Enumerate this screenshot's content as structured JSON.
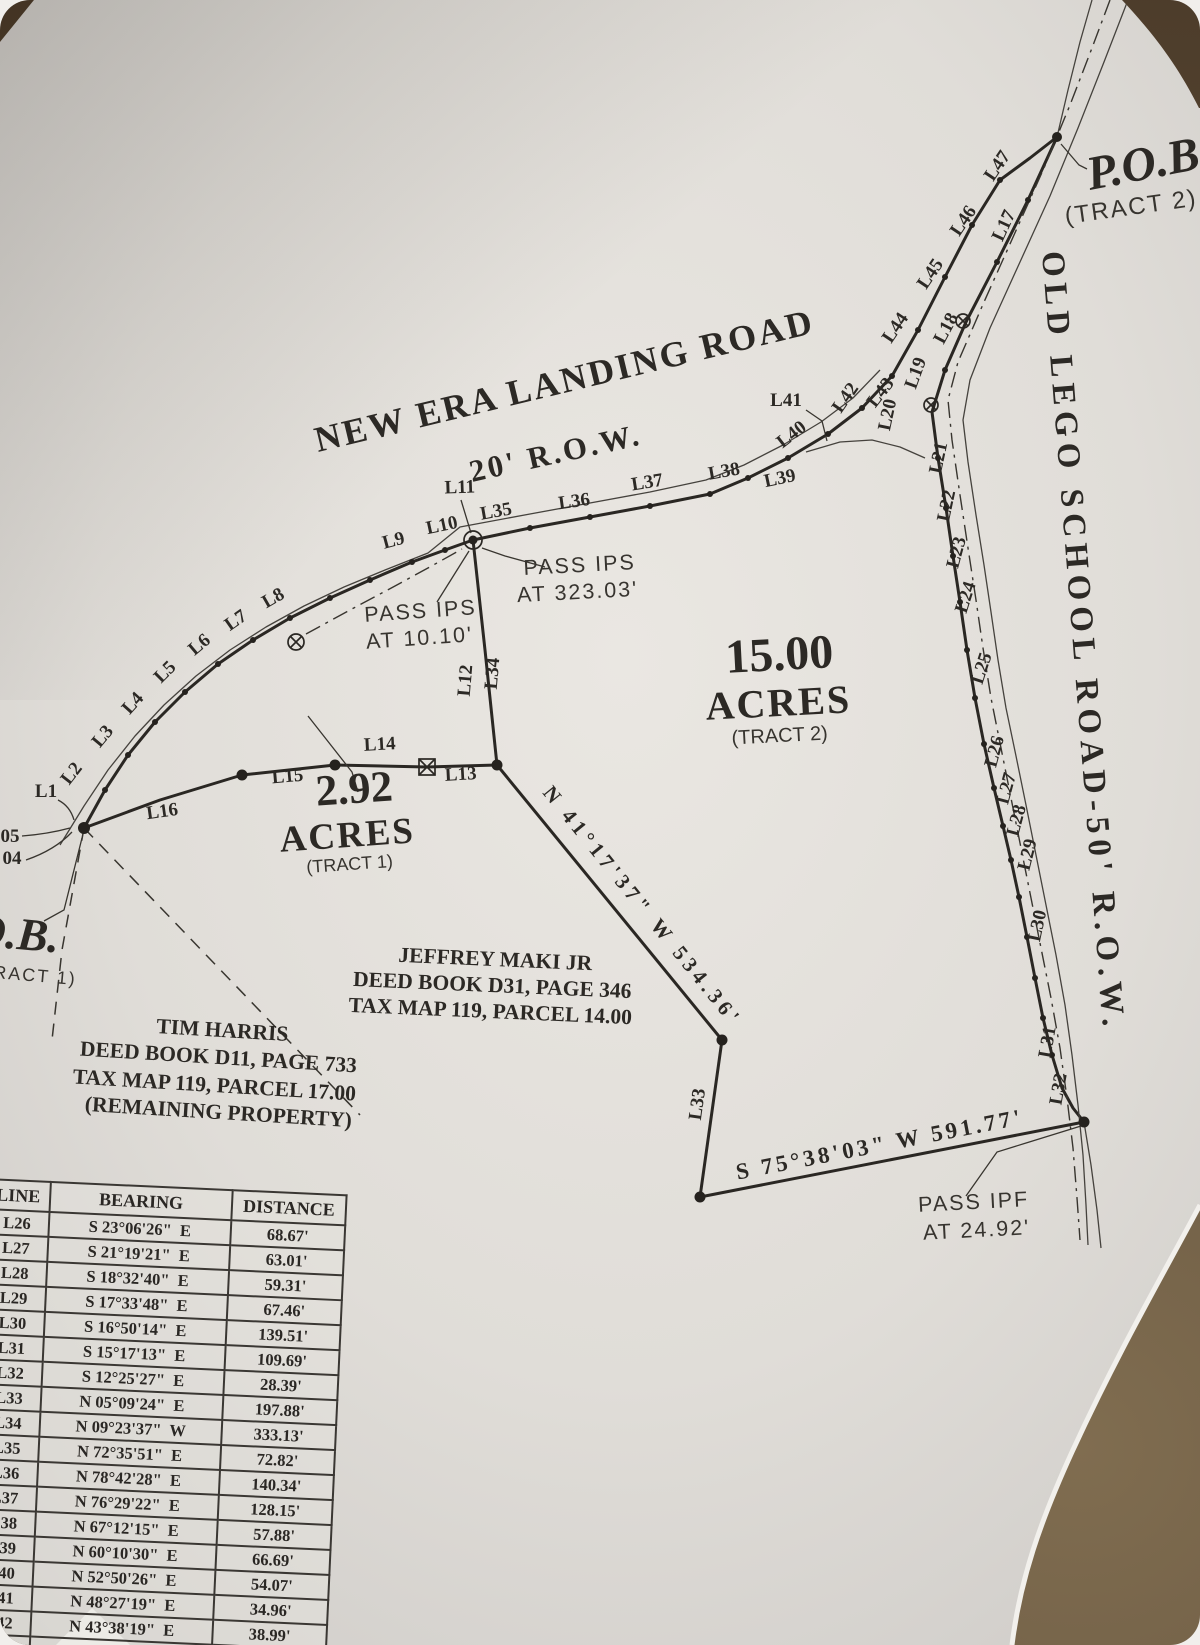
{
  "roads": {
    "new_era": {
      "name": "NEW ERA LANDING ROAD",
      "row": "20' R.O.W."
    },
    "old_lego": {
      "name": "OLD LEGO SCHOOL ROAD-50' R.O.W."
    }
  },
  "pob_tract2": {
    "title": "P.O.B.",
    "subtitle": "(TRACT 2)"
  },
  "pob_tract1": {
    "title": "P.O.B.",
    "subtitle": "(TRACT 1)"
  },
  "tracts": {
    "tract2": {
      "area": "15.00",
      "unit": "ACRES",
      "label": "(TRACT 2)"
    },
    "tract1": {
      "area": "2.92",
      "unit": "ACRES",
      "label": "(TRACT 1)"
    }
  },
  "owners": {
    "maki": {
      "line1": "JEFFREY MAKI JR",
      "line2": "DEED BOOK D31, PAGE 346",
      "line3": "TAX MAP 119, PARCEL 14.00"
    },
    "harris": {
      "line1": "TIM HARRIS",
      "line2": "DEED BOOK D11, PAGE 733",
      "line3": "TAX MAP 119, PARCEL 17.00",
      "line4": "(REMAINING PROPERTY)"
    }
  },
  "notes": {
    "pass_ips_323": {
      "line1": "PASS IPS",
      "line2": "AT 323.03'"
    },
    "pass_ips_10": {
      "line1": "PASS IPS",
      "line2": "AT 10.10'"
    },
    "pass_ipf": {
      "line1": "PASS IPF",
      "line2": "AT 24.92'"
    }
  },
  "bearings": {
    "diagonal": "N 41°17'37\" W  534.36'",
    "bottom": "S 75°38'03\" W  591.77'"
  },
  "edge": {
    "n05": "05",
    "n04": "04"
  },
  "seg": {
    "L1": "L1",
    "L2": "L2",
    "L3": "L3",
    "L4": "L4",
    "L5": "L5",
    "L6": "L6",
    "L7": "L7",
    "L8": "L8",
    "L9": "L9",
    "L10": "L10",
    "L11": "L11",
    "L12": "L12",
    "L13": "L13",
    "L14": "L14",
    "L15": "L15",
    "L16": "L16",
    "L17": "L17",
    "L18": "L18",
    "L19": "L19",
    "L20": "L20",
    "L21": "L21",
    "L22": "L22",
    "L23": "L23",
    "L24": "L24",
    "L25": "L25",
    "L26": "L26",
    "L27": "L27",
    "L28": "L28",
    "L29": "L29",
    "L30": "L30",
    "L31": "L31",
    "L32": "L32",
    "L33": "L33",
    "L34": "L34",
    "L35": "L35",
    "L36": "L36",
    "L37": "L37",
    "L38": "L38",
    "L39": "L39",
    "L40": "L40",
    "L41": "L41",
    "L42": "L42",
    "L43": "L43",
    "L44": "L44",
    "L45": "L45",
    "L46": "L46",
    "L47": "L47"
  },
  "table": {
    "headers": [
      "LINE",
      "BEARING",
      "DISTANCE"
    ],
    "rows": [
      {
        "line": "L26",
        "bearing": "S 23°06'26\"  E",
        "distance": "68.67'"
      },
      {
        "line": "L27",
        "bearing": "S 21°19'21\"  E",
        "distance": "63.01'"
      },
      {
        "line": "L28",
        "bearing": "S 18°32'40\"  E",
        "distance": "59.31'"
      },
      {
        "line": "L29",
        "bearing": "S 17°33'48\"  E",
        "distance": "67.46'"
      },
      {
        "line": "L30",
        "bearing": "S 16°50'14\"  E",
        "distance": "139.51'"
      },
      {
        "line": "L31",
        "bearing": "S 15°17'13\"  E",
        "distance": "109.69'"
      },
      {
        "line": "L32",
        "bearing": "S 12°25'27\"  E",
        "distance": "28.39'"
      },
      {
        "line": "L33",
        "bearing": "N 05°09'24\"  E",
        "distance": "197.88'"
      },
      {
        "line": "L34",
        "bearing": "N 09°23'37\"  W",
        "distance": "333.13'"
      },
      {
        "line": "L35",
        "bearing": "N 72°35'51\"  E",
        "distance": "72.82'"
      },
      {
        "line": "L36",
        "bearing": "N 78°42'28\"  E",
        "distance": "140.34'"
      },
      {
        "line": "L37",
        "bearing": "N 76°29'22\"  E",
        "distance": "128.15'"
      },
      {
        "line": "L38",
        "bearing": "N 67°12'15\"  E",
        "distance": "57.88'"
      },
      {
        "line": "L39",
        "bearing": "N 60°10'30\"  E",
        "distance": "66.69'"
      },
      {
        "line": "L40",
        "bearing": "N 52°50'26\"  E",
        "distance": "54.07'"
      },
      {
        "line": "L41",
        "bearing": "N 48°27'19\"  E",
        "distance": "34.96'"
      },
      {
        "line": "L42",
        "bearing": "N 43°38'19\"  E",
        "distance": "38.99'"
      },
      {
        "line": "L43",
        "bearing": "N 36°49'31\"  E",
        "distance": "59.57'"
      },
      {
        "line": "L44",
        "bearing": "N 30°02'17\"  E",
        "distance": ""
      }
    ]
  }
}
